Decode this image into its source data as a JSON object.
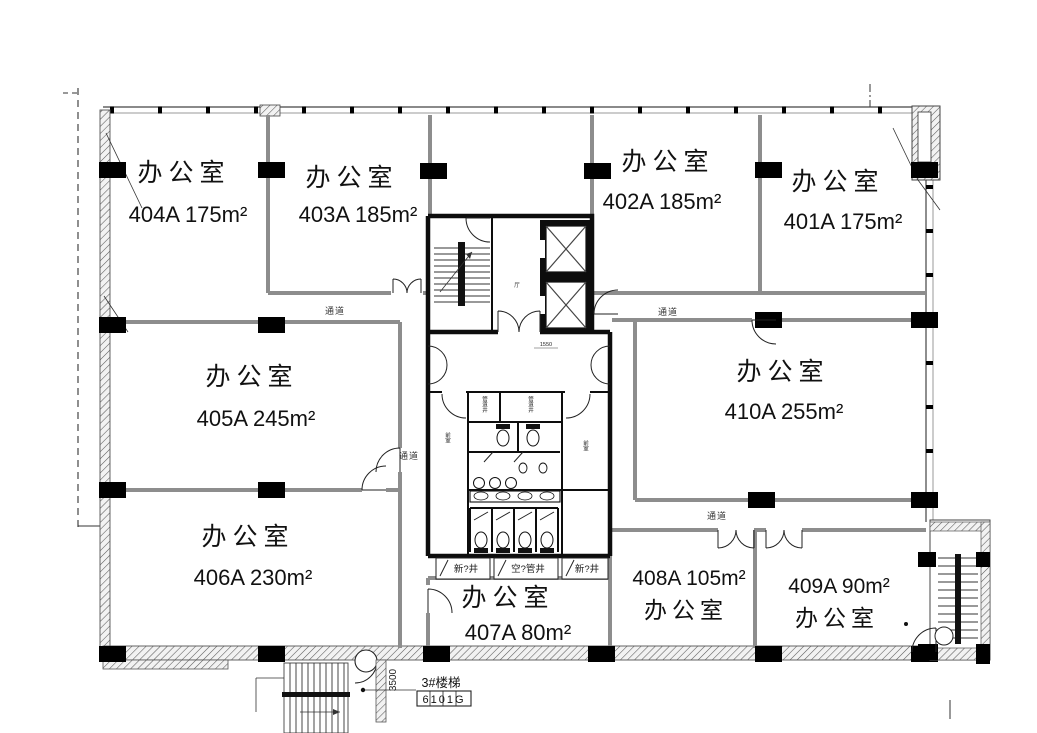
{
  "floorplan": {
    "rooms": [
      {
        "type": "办公室",
        "code": "404A  175m²"
      },
      {
        "type": "办公室",
        "code": "403A  185m²"
      },
      {
        "type": "办公室",
        "code": "402A  185m²"
      },
      {
        "type": "办公室",
        "code": "401A  175m²"
      },
      {
        "type": "办公室",
        "code": "405A  245m²"
      },
      {
        "type": "办公室",
        "code": "410A  255m²"
      },
      {
        "type": "办公室",
        "code": "406A  230m²"
      },
      {
        "type": "办公室",
        "code": "407A  80m²"
      },
      {
        "type": "办公室",
        "code": "408A  105m²"
      },
      {
        "type": "办公室",
        "code": "409A  90m²"
      }
    ],
    "corridors": {
      "left": "通道",
      "right": "通道",
      "mid": "通道",
      "lower": "通道"
    },
    "shafts": {
      "left": "新?井",
      "center": "空?管井",
      "right": "新?井"
    },
    "core": {
      "lobby": "厅",
      "shaft_a": "管道井",
      "shaft_b": "管道井",
      "ante_a": "前室",
      "ante_b": "前室",
      "dim": "1550"
    },
    "stair_note": {
      "title": "3#楼梯",
      "tag": "6101G",
      "dim": "3500"
    }
  }
}
